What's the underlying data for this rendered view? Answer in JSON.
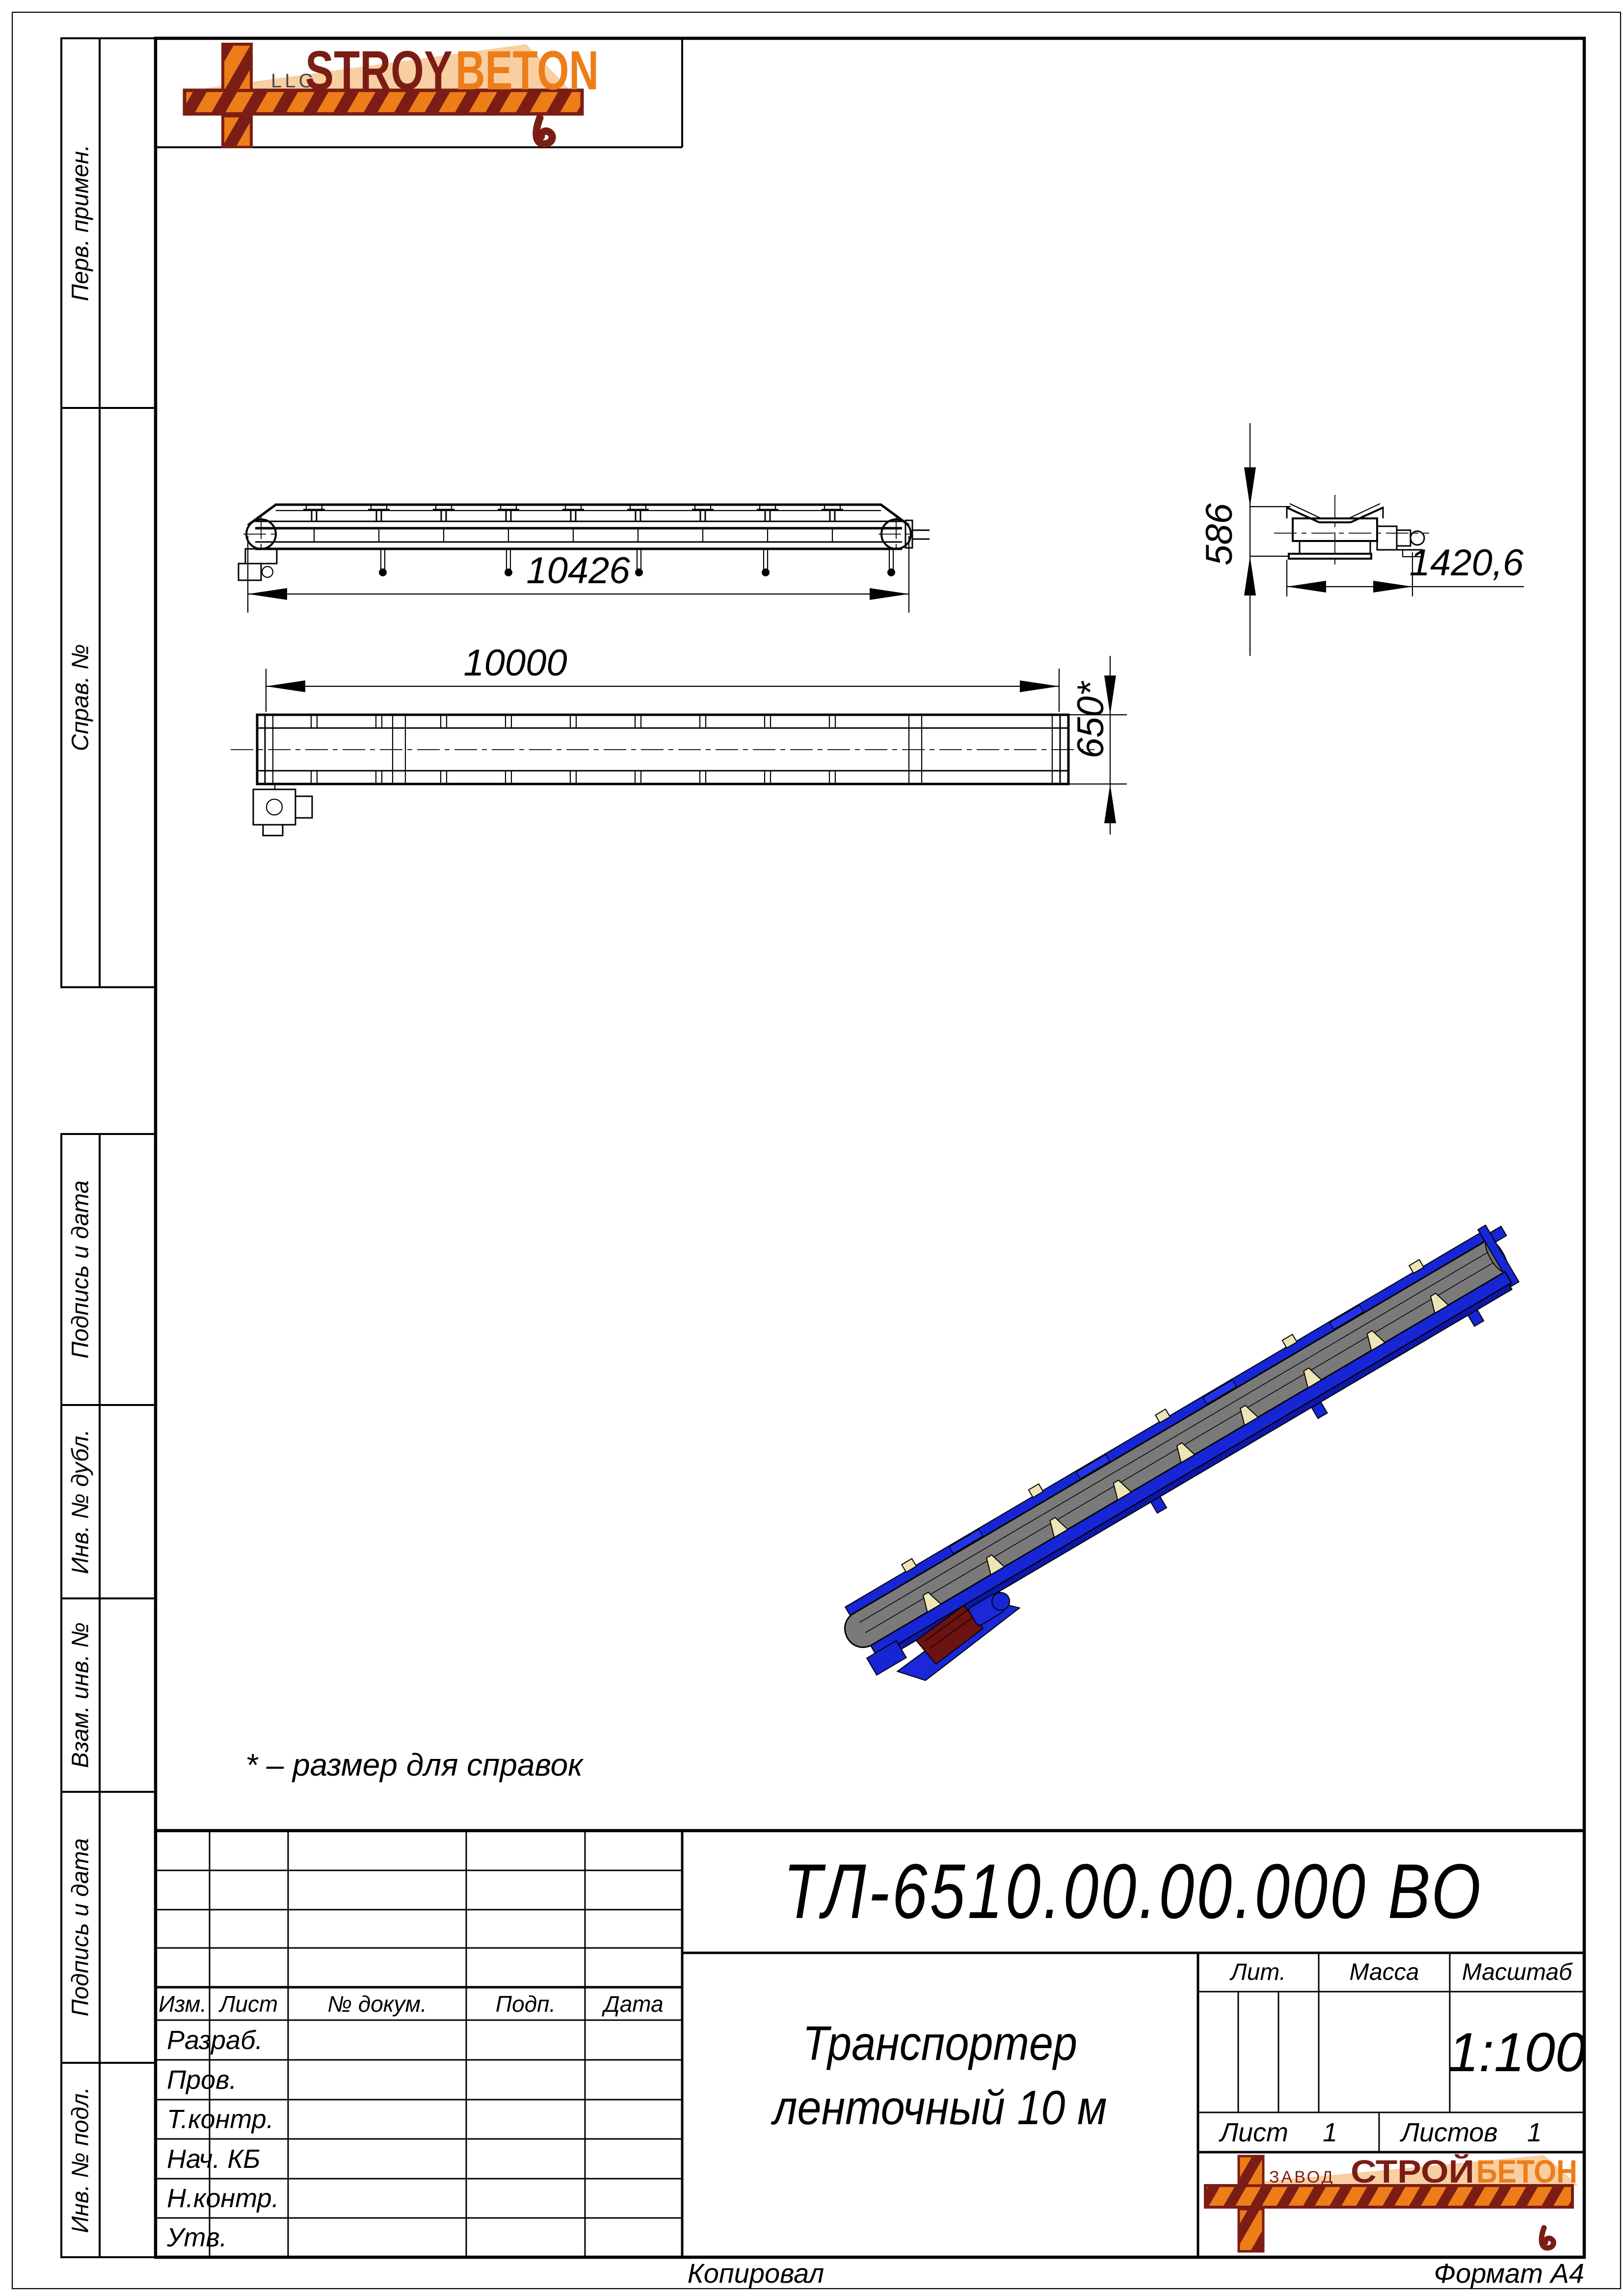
{
  "top_logo": {
    "llc": "LLC",
    "stroy": "STROY",
    "beton": "BETON"
  },
  "bottom_logo": {
    "zavod": "ЗАВОД",
    "stroy": "СТРОЙ",
    "beton": "БЕТОН"
  },
  "sidebar": {
    "items": [
      "Перв. примен.",
      "Справ. №",
      "Подпись и дата",
      "Инв. № дубл.",
      "Взам. инв. №",
      "Подпись и дата",
      "Инв. № подл."
    ]
  },
  "note": "* – размер для справок",
  "dimensions": {
    "overall_length": "10426",
    "frame_length": "10000",
    "belt_width": "650*",
    "drive_height": "586",
    "end_width": "1420,6"
  },
  "title_block": {
    "designation": "ТЛ-6510.00.00.000 ВО",
    "name_line1": "Транспортер",
    "name_line2": "ленточный 10 м",
    "lit_label": "Лит.",
    "mass_label": "Масса",
    "scale_label": "Масштаб",
    "scale_value": "1:100",
    "sheet_label": "Лист",
    "sheet_value": "1",
    "sheets_label": "Листов",
    "sheets_value": "1",
    "columns": [
      "Изм.",
      "Лист",
      "№ докум.",
      "Подп.",
      "Дата"
    ],
    "rows": [
      "Разраб.",
      "Пров.",
      "Т.контр.",
      "Нач. КБ",
      "Н.контр.",
      "Утв."
    ]
  },
  "footer": {
    "left": "Копировал",
    "right": "Формат А4"
  },
  "colors": {
    "brand_dark_red": "#7B1D15",
    "brand_orange": "#ED7D18",
    "brand_peach": "#F8CFA2",
    "iso_belt_gray": "#7A7A7A",
    "iso_frame_blue": "#1626D4",
    "iso_bracket_cream": "#EDE5B6",
    "iso_motor_red": "#6D1212"
  }
}
